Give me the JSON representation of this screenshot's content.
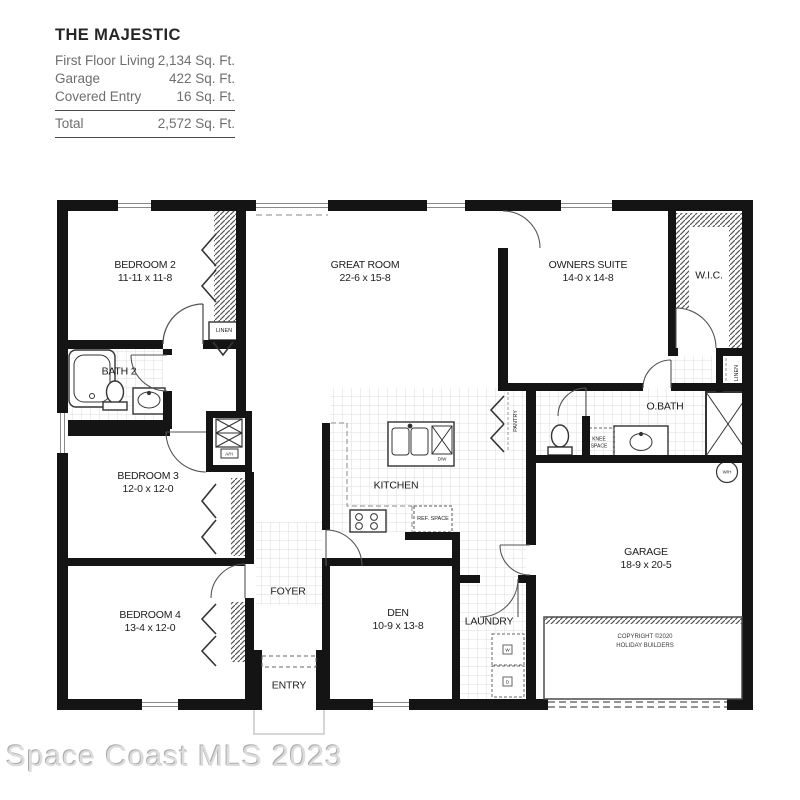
{
  "title_block": {
    "title": "THE MAJESTIC",
    "rows": [
      {
        "label": "First Floor Living",
        "value": "2,134 Sq. Ft."
      },
      {
        "label": "Garage",
        "value": "422 Sq. Ft."
      },
      {
        "label": "Covered Entry",
        "value": "16 Sq. Ft."
      }
    ],
    "total_label": "Total",
    "total_value": "2,572 Sq. Ft."
  },
  "rooms": {
    "bedroom2": {
      "name": "BEDROOM 2",
      "dims": "11-11 x 11-8"
    },
    "bath2": {
      "name": "BATH 2",
      "dims": ""
    },
    "bedroom3": {
      "name": "BEDROOM 3",
      "dims": "12-0 x 12-0"
    },
    "bedroom4": {
      "name": "BEDROOM 4",
      "dims": "13-4 x 12-0"
    },
    "great_room": {
      "name": "GREAT ROOM",
      "dims": "22-6 x 15-8"
    },
    "owners_suite": {
      "name": "OWNERS SUITE",
      "dims": "14-0 x 14-8"
    },
    "wic": {
      "name": "W.I.C.",
      "dims": ""
    },
    "obath": {
      "name": "O.BATH",
      "dims": ""
    },
    "kitchen": {
      "name": "KITCHEN",
      "dims": ""
    },
    "foyer": {
      "name": "FOYER",
      "dims": ""
    },
    "den": {
      "name": "DEN",
      "dims": "10-9 x 13-8"
    },
    "laundry": {
      "name": "LAUNDRY",
      "dims": ""
    },
    "entry": {
      "name": "ENTRY",
      "dims": ""
    },
    "garage": {
      "name": "GARAGE",
      "dims": "18-9 x 20-5"
    }
  },
  "labels": {
    "linen_bedroom2": "LINEN",
    "linen_obath": "LINEN",
    "pantry": "PANTRY",
    "knee_space": "KNEE SPACE",
    "ref_space": "REF. SPACE",
    "air_handler": "A/H",
    "water_heater": "W/H",
    "dishwasher": "D/W",
    "washer": "W",
    "dryer": "D"
  },
  "copyright": {
    "line1": "COPYRIGHT ©2020",
    "line2": "HOLIDAY BUILDERS"
  },
  "watermark": "Space Coast MLS 2023",
  "colors": {
    "wall": "#141414",
    "tile_grid": "#dedede",
    "hatch": "#555555",
    "text": "#1c1c1c",
    "watermark_text": "#dcdcdc"
  }
}
